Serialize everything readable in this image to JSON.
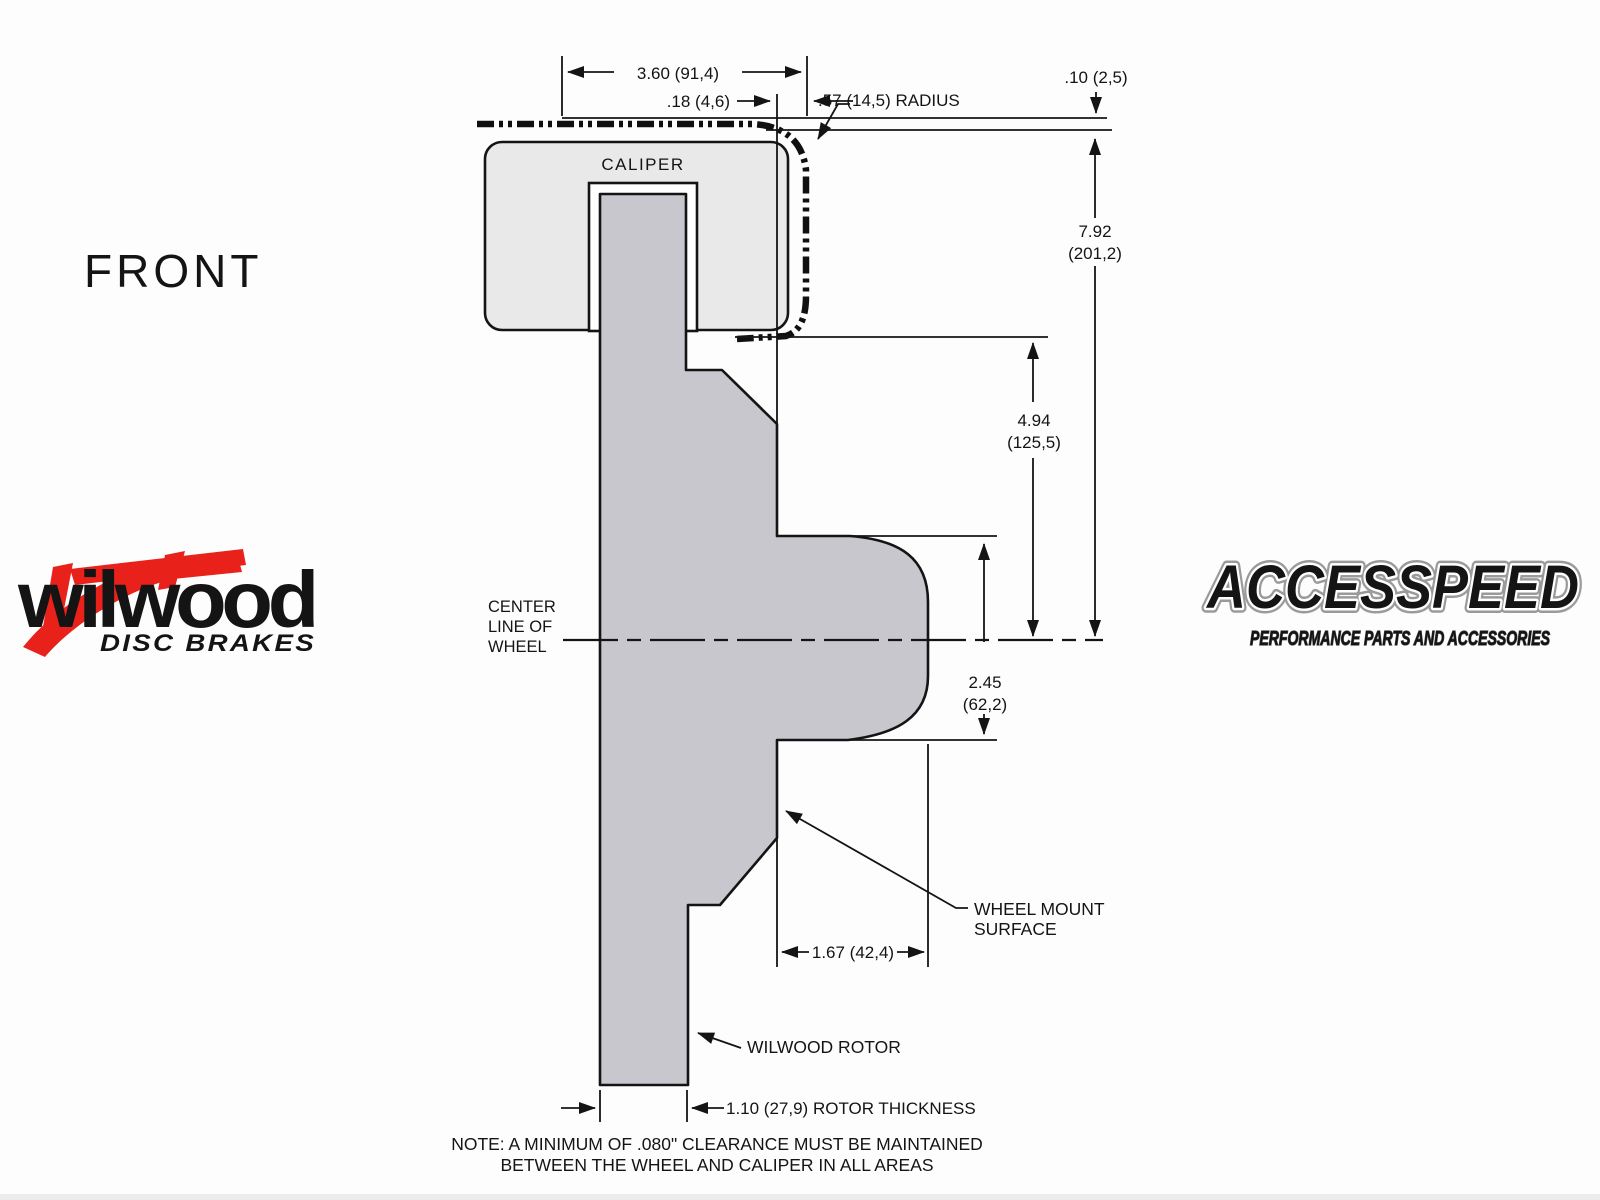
{
  "front_label": "FRONT",
  "note": {
    "line1": "NOTE: A MINIMUM OF .080\" CLEARANCE MUST BE MAINTAINED",
    "line2": "BETWEEN THE WHEEL AND CALIPER IN ALL AREAS"
  },
  "diagram": {
    "caliper_label": "CALIPER",
    "centerline": {
      "line1": "CENTER",
      "line2": "LINE OF",
      "line3": "WHEEL"
    },
    "wheel_mount": {
      "line1": "WHEEL MOUNT",
      "line2": "SURFACE"
    },
    "rotor_label": "WILWOOD ROTOR",
    "dimensions": {
      "width_3_60": "3.60 (91,4)",
      "offset_0_18": ".18 (4,6)",
      "radius_0_57": ".57 (14,5) RADIUS",
      "clearance_0_10": ".10 (2,5)",
      "height_7_92_in": "7.92",
      "height_7_92_mm": "(201,2)",
      "height_4_94_in": "4.94",
      "height_4_94_mm": "(125,5)",
      "height_2_45_in": "2.45",
      "height_2_45_mm": "(62,2)",
      "depth_1_67": "1.67 (42,4)",
      "rotor_thickness": "1.10 (27,9) ROTOR THICKNESS"
    },
    "colors": {
      "caliper_fill": "#e9e9e9",
      "rotor_fill": "#c7c7cd",
      "line": "#141414",
      "wilwood_red": "#e8221a"
    }
  },
  "logos": {
    "wilwood": {
      "name": "wilwood",
      "tagline": "DISC BRAKES"
    },
    "accesspeed": {
      "name": "ACCESSPEED",
      "tagline": "PERFORMANCE PARTS AND ACCESSORIES"
    }
  }
}
